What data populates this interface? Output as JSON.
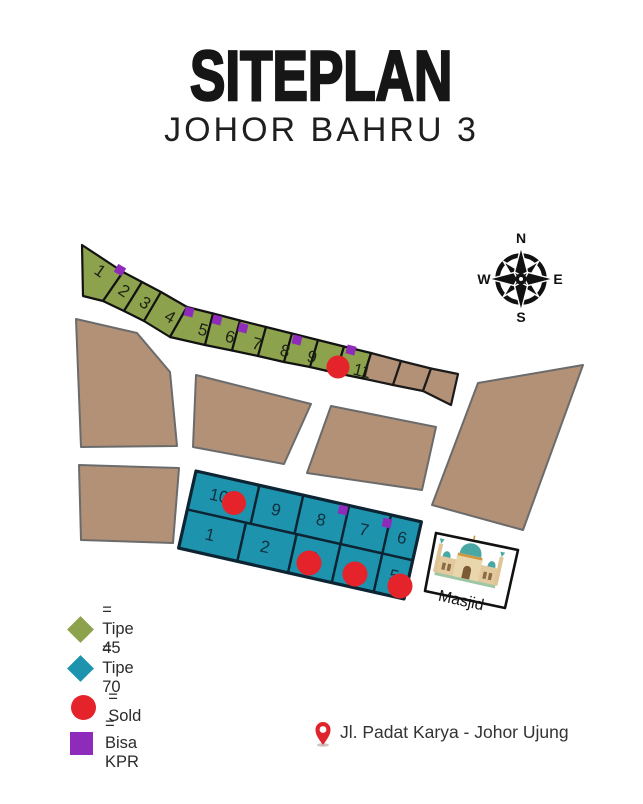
{
  "header": {
    "title": "SITEPLAN",
    "subtitle": "JOHOR BAHRU 3"
  },
  "compass": {
    "n": "N",
    "e": "E",
    "s": "S",
    "w": "W"
  },
  "map": {
    "mosque_label": "Masjid",
    "tipe45_plots": [
      {
        "number": "1",
        "sold": false,
        "kpr": false
      },
      {
        "number": "2",
        "sold": false,
        "kpr": true
      },
      {
        "number": "3",
        "sold": false,
        "kpr": false
      },
      {
        "number": "4",
        "sold": false,
        "kpr": false
      },
      {
        "number": "5",
        "sold": false,
        "kpr": true
      },
      {
        "number": "6",
        "sold": false,
        "kpr": true
      },
      {
        "number": "7",
        "sold": false,
        "kpr": true
      },
      {
        "number": "8",
        "sold": false,
        "kpr": false
      },
      {
        "number": "9",
        "sold": false,
        "kpr": true
      },
      {
        "number": "10",
        "sold": true,
        "kpr": false
      },
      {
        "number": "11",
        "sold": false,
        "kpr": true
      }
    ],
    "tipe70_top_row": [
      {
        "number": "10",
        "sold": true,
        "kpr": false
      },
      {
        "number": "9",
        "sold": false,
        "kpr": false
      },
      {
        "number": "8",
        "sold": false,
        "kpr": true
      },
      {
        "number": "7",
        "sold": false,
        "kpr": true
      },
      {
        "number": "6",
        "sold": false,
        "kpr": false
      }
    ],
    "tipe70_bottom_row": [
      {
        "number": "1",
        "sold": false,
        "kpr": false
      },
      {
        "number": "2",
        "sold": false,
        "kpr": false
      },
      {
        "number": "3",
        "sold": true,
        "kpr": false
      },
      {
        "number": "4",
        "sold": true,
        "kpr": false
      },
      {
        "number": "5",
        "sold": true,
        "kpr": false
      }
    ]
  },
  "legend": {
    "items": [
      {
        "label": "= Tipe 45",
        "shape": "diamond",
        "color": "#8DA24C"
      },
      {
        "label": "= Tipe 70",
        "shape": "diamond",
        "color": "#1E93AE"
      },
      {
        "label": "= Sold",
        "shape": "circle",
        "color": "#E5232B"
      },
      {
        "label": "= Bisa KPR",
        "shape": "square",
        "color": "#8F2BBB"
      }
    ]
  },
  "footer": {
    "address": "Jl. Padat Karya - Johor Ujung"
  },
  "colors": {
    "tipe45_fill": "#8DA24C",
    "tipe70_fill": "#1E93AE",
    "reserved_fill": "#B39177",
    "sold": "#E5232B",
    "kpr": "#8F2BBB",
    "pin": "#E0242C"
  }
}
